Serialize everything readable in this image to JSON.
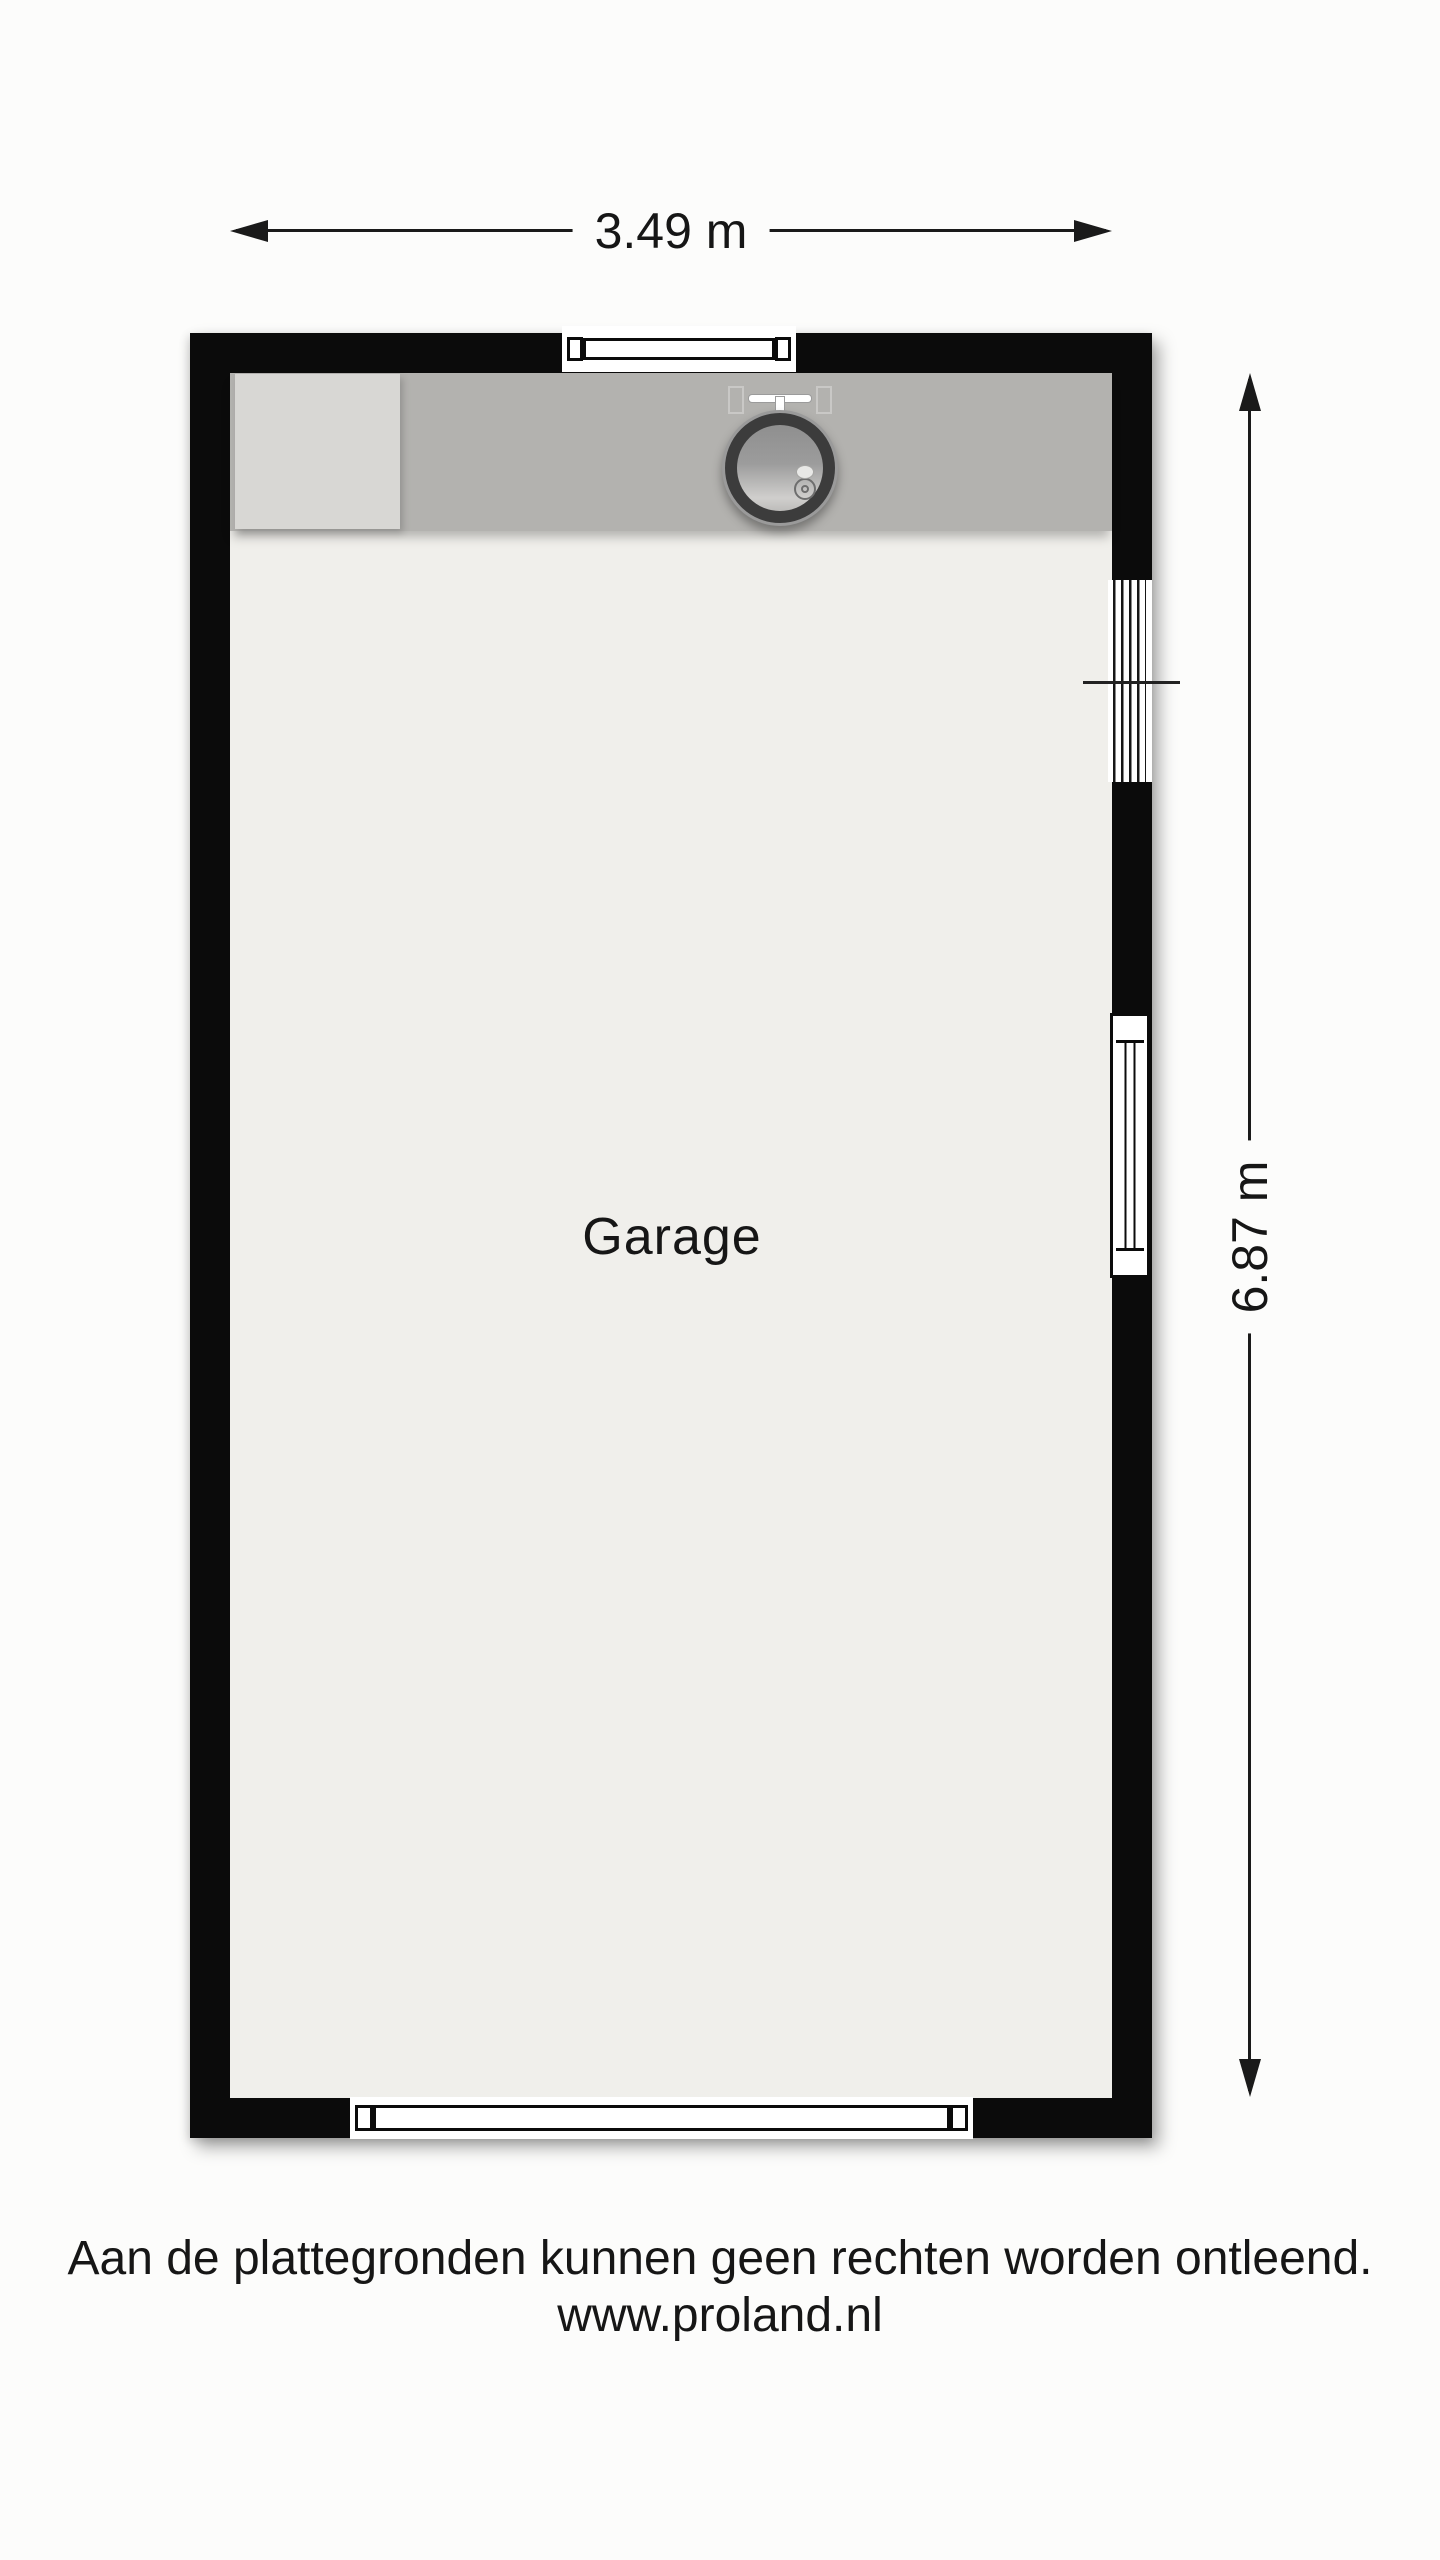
{
  "floor_plan": {
    "room_label": "Garage",
    "width_dimension": "3.49 m",
    "height_dimension": "6.87 m",
    "features": [
      "counter",
      "appliance",
      "sink",
      "top-window",
      "louvre-window",
      "sash-window",
      "garage-door"
    ]
  },
  "footer": {
    "disclaimer": "Aan de plattegronden kunnen geen rechten worden ontleend.",
    "website": "www.proland.nl"
  },
  "colors": {
    "wall": "#0b0b0b",
    "floor": "#f0efeb",
    "counter": "#b3b2af",
    "appliance": "#d8d7d4",
    "background": "#fcfcfb",
    "line": "#1a1a1a",
    "text": "#161616"
  }
}
